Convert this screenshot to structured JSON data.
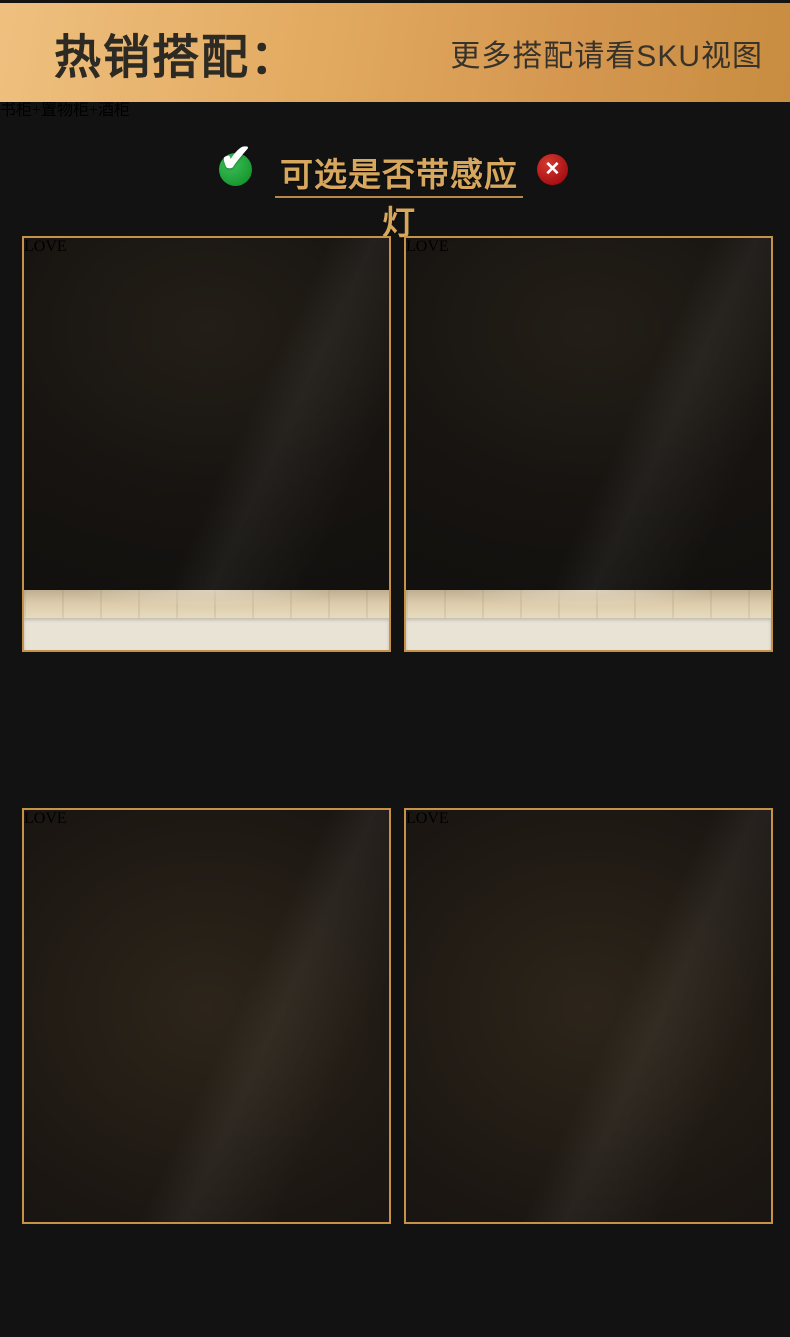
{
  "banner": {
    "title": "热销搭配：",
    "note": "更多搭配请看SKU视图",
    "colors": {
      "gradient_left": "#eec07f",
      "gradient_right": "#c88d40",
      "text": "#2d2a24"
    }
  },
  "option_line": {
    "text": "可选是否带感应灯",
    "check_glyph": "✔",
    "cross_glyph": "✕",
    "colors": {
      "check_bg": "#1fa33c",
      "cross_bg": "#b3111b",
      "text_gold": "#d8a75e",
      "underline": "#b8884a"
    }
  },
  "decor": {
    "love_sign": "LOVE"
  },
  "combos": [
    {
      "caption_line1": "书柜+置物柜+酒柜",
      "caption_line2": "+书柜+顶柜"
    },
    {
      "caption_line1": "书柜+置物柜+酒柜+顶柜",
      "caption_line2": ""
    },
    {
      "caption_line1": "书柜+置物柜+书柜",
      "caption_line2": ""
    },
    {
      "caption_line1": "书柜+置物柜+酒柜",
      "caption_line2": ""
    }
  ],
  "colors": {
    "page_bg": "#121212",
    "accent_gold": "#c6924a",
    "caption_gold": "#cd9743"
  }
}
